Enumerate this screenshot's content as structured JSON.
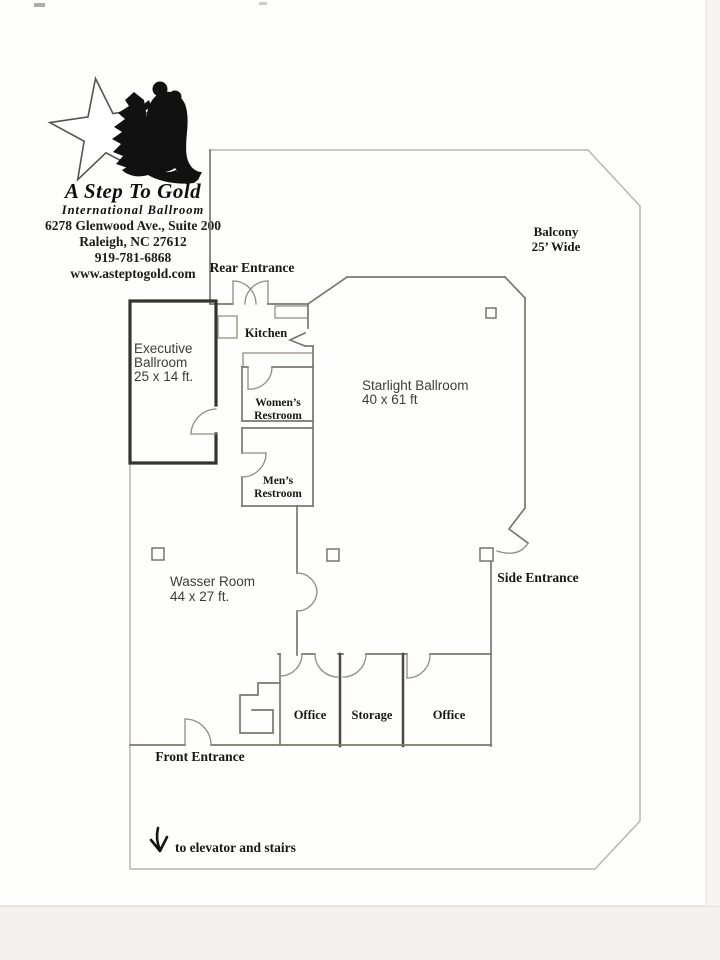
{
  "logo": {
    "name": "A Step To Gold",
    "subtitle": "International Ballroom",
    "address1": "6278 Glenwood Ave., Suite 200",
    "address2": "Raleigh, NC 27612",
    "phone": "919-781-6868",
    "website": "www.asteptogold.com"
  },
  "labels": {
    "rear_entrance": "Rear Entrance",
    "balcony_1": "Balcony",
    "balcony_2": "25’ Wide",
    "kitchen": "Kitchen",
    "executive_1": "Executive",
    "executive_2": "Ballroom",
    "executive_3": "25 x 14 ft.",
    "starlight_1": "Starlight Ballroom",
    "starlight_2": "40 x 61 ft",
    "womens_1": "Women’s",
    "womens_2": "Restroom",
    "mens_1": "Men’s",
    "mens_2": "Restroom",
    "wasser_1": "Wasser Room",
    "wasser_2": "44 x 27 ft.",
    "side_entrance": "Side Entrance",
    "office_left": "Office",
    "storage": "Storage",
    "office_right": "Office",
    "front_entrance": "Front Entrance",
    "elevator_note": "to elevator and stairs"
  },
  "colors": {
    "wall": "#7b786e",
    "outer_boundary": "#b9b6ac",
    "thick_wall": "#35332e",
    "silhouette": "#111111",
    "text": "#171717"
  }
}
